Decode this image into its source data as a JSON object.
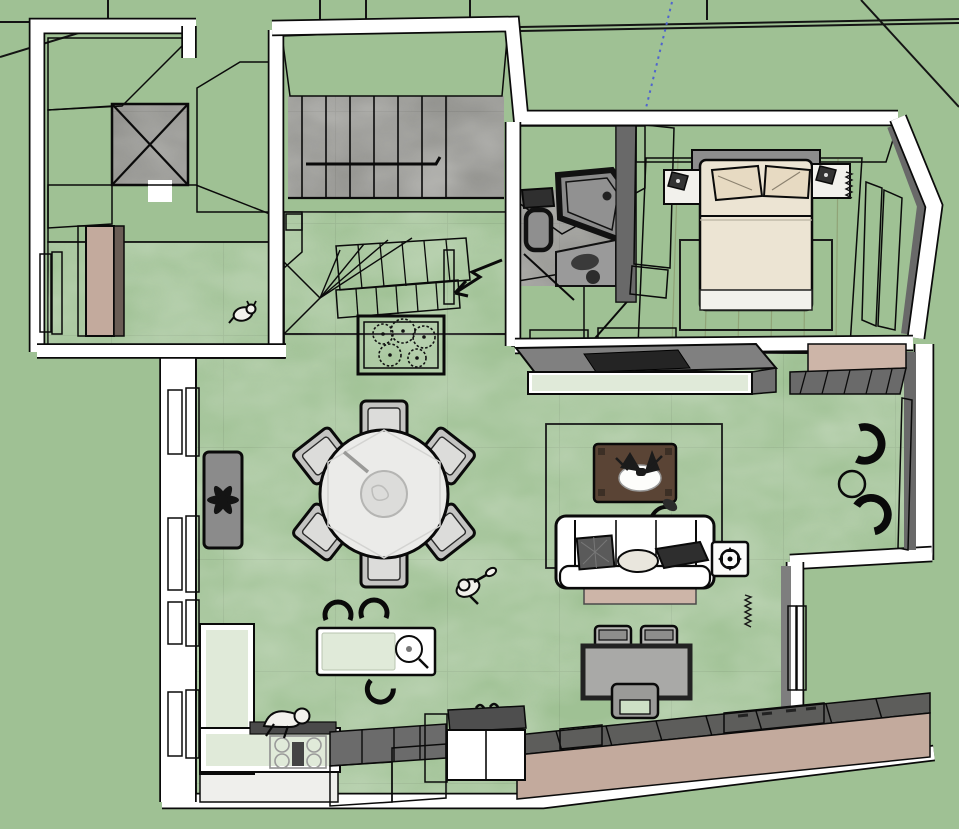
{
  "canvas": {
    "width": 959,
    "height": 829
  },
  "colors": {
    "grass": "#9fc194",
    "ink": "#0a0a0a",
    "wall_white": "#ffffff",
    "wall_gray": "#7e7e7e",
    "wall_gray_dark": "#696969",
    "wall_gray_mid": "#8d8d8b",
    "floor_concrete": "#92928e",
    "wood_floor": "#c9ab82",
    "mint": "#e0ead9",
    "glass_green": "#cde0c5",
    "tan": "#c3aa9d",
    "tan_light": "#cdb5a8",
    "brown_table": "#5a4435",
    "base_dark": "#57493f",
    "bed_linen": "#ece4d3",
    "pillow": "#e7dac2",
    "steel": "#4d4d4d",
    "chair_gray": "#c4c4c2",
    "chair_inner": "#dcdcda",
    "tv_dark": "#242424",
    "soft_white": "#f2f1ec",
    "axis_blue": "#4f64cf"
  },
  "scene": {
    "view": "top-down-3d-floor-plan",
    "ground": "grass-lawn",
    "rooms": [
      "stair-core",
      "entry-hall",
      "upper-staircase",
      "winder-staircase",
      "bathroom",
      "bedroom",
      "living-room",
      "dining-area",
      "kitchen",
      "reading-nook",
      "desk-area"
    ],
    "furniture": [
      "double-bed",
      "nightstand-left",
      "nightstand-right",
      "wardrobe",
      "bedroom-rug",
      "toilet",
      "corner-shower",
      "vanity-sink",
      "tv-console",
      "tv",
      "sofa",
      "sofa-cushions",
      "coffee-table",
      "side-table",
      "floor-lamp",
      "area-rug",
      "dining-table",
      "dining-chairs",
      "radiator",
      "planter-box",
      "entry-door",
      "kitchen-counter",
      "cooktop",
      "kitchen-island",
      "island-sink",
      "bar-stools",
      "tall-white-cabinet",
      "long-sideboard",
      "right-sideboard",
      "desk",
      "desk-chairs",
      "armchair-pair",
      "nook-round-table"
    ],
    "figures": [
      "person-walking",
      "person-leaning",
      "dog"
    ],
    "annotations": [
      "section-zigzag-arrow",
      "blue-axis-line",
      "terrain-edges"
    ]
  }
}
